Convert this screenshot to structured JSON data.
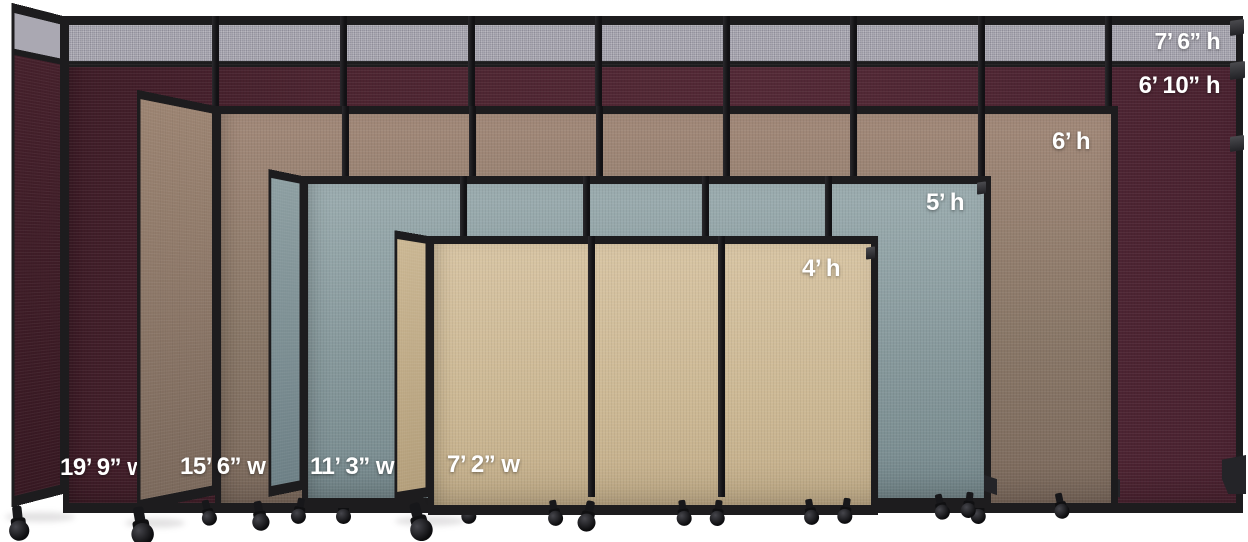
{
  "scene": {
    "background": "#ffffff",
    "frame_color": "#1d1c1e",
    "floor_color": "#ffffff"
  },
  "partitions": [
    {
      "name": "cranberry",
      "fabric_color": "#4c2430",
      "top_strip_color": "#a7a5af",
      "height_label_with_topper": "7’ 6” h",
      "height_label": "6’ 10” h",
      "width_label": "19’ 9” w",
      "panels_in_run": 9
    },
    {
      "name": "mocha",
      "fabric_color": "#8a7868",
      "height_label": "6’ h",
      "width_label": "15’ 6” w",
      "panels_in_run": 7
    },
    {
      "name": "slate",
      "fabric_color": "#87999c",
      "height_label": "5’ h",
      "width_label": "11’ 3” w",
      "panels_in_run": 5
    },
    {
      "name": "sand",
      "fabric_color": "#cdb995",
      "height_label": "4’ h",
      "width_label": "7’ 2” w",
      "panels_in_run": 3
    }
  ]
}
